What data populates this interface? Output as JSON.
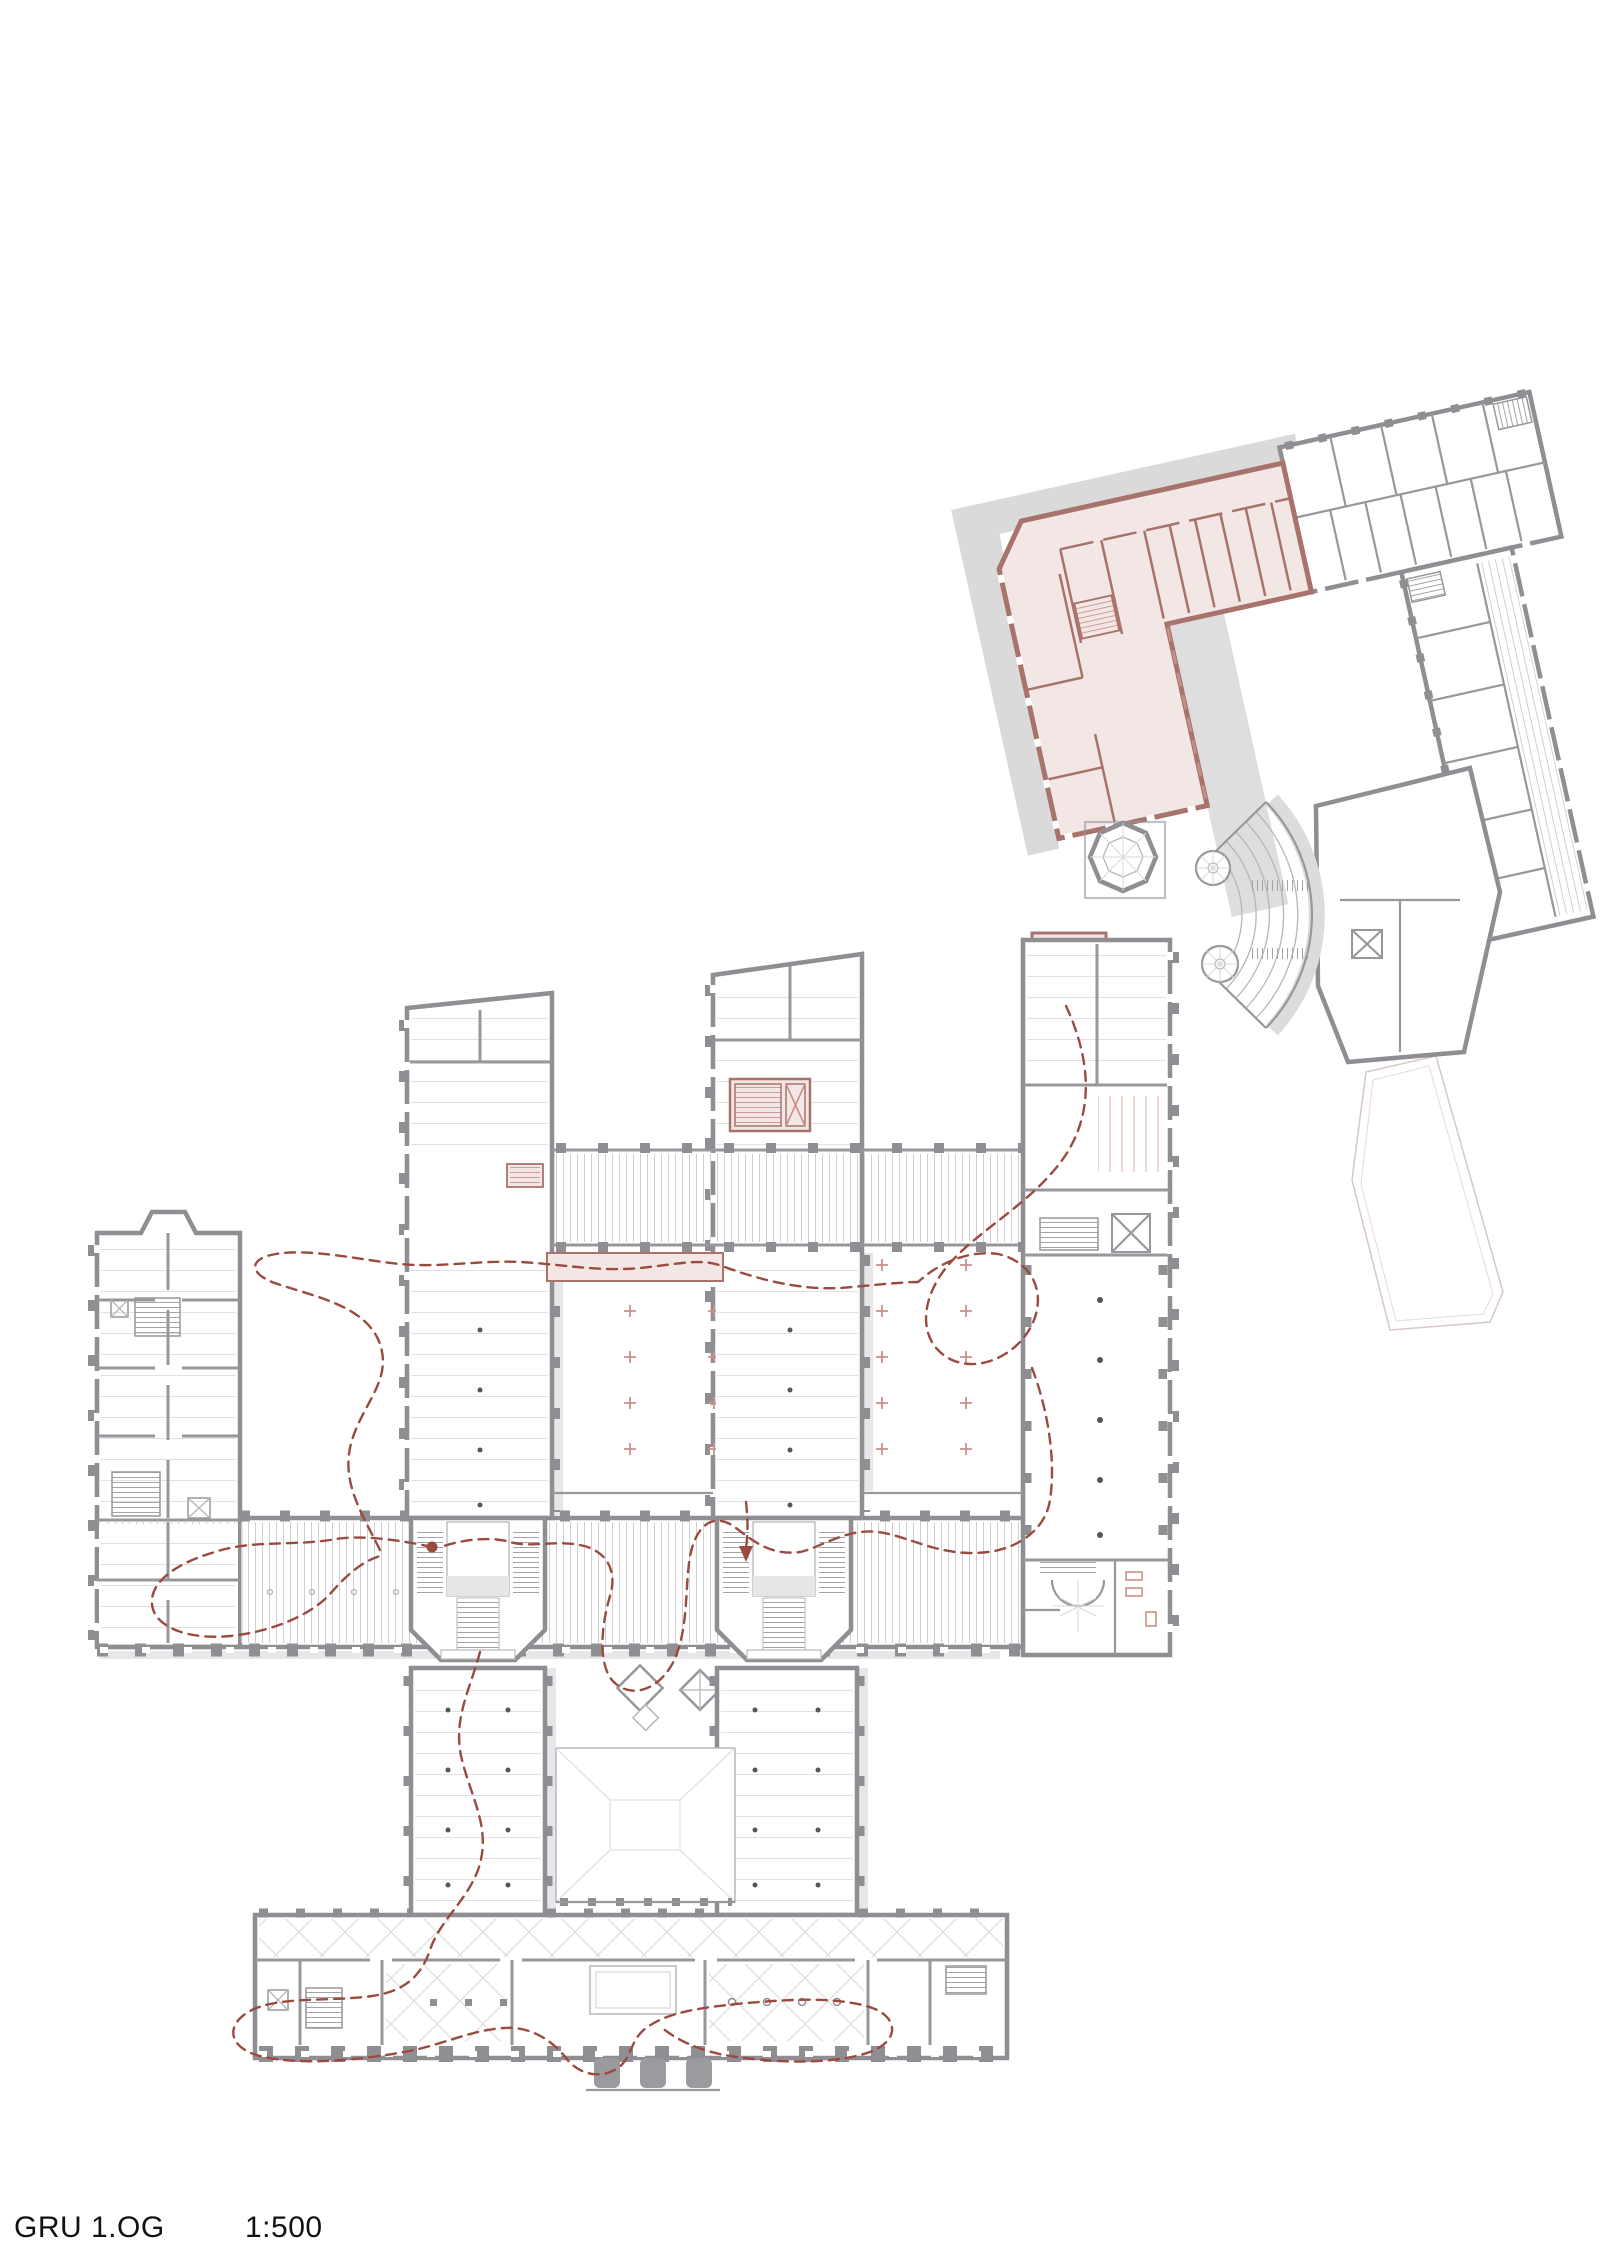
{
  "caption": {
    "drawing_code": "GRU 1.OG",
    "scale": "1:500"
  },
  "colors": {
    "wall": "#8e8e93",
    "part": "#97979c",
    "thin": "#b7b7bb",
    "xthin": "#d9d9dc",
    "shadow": "#dadada",
    "newfill": "#f3e7e6",
    "newwall": "#a8736c",
    "newlight": "#c9908a",
    "circ": "#9a4b40",
    "text": "#111111"
  },
  "plan": {
    "type": "architectural-floor-plan",
    "floor": "1.OG",
    "highlight_meaning": "new-intervention-pink",
    "path_meaning": "visitor-circulation-dashed-red"
  }
}
